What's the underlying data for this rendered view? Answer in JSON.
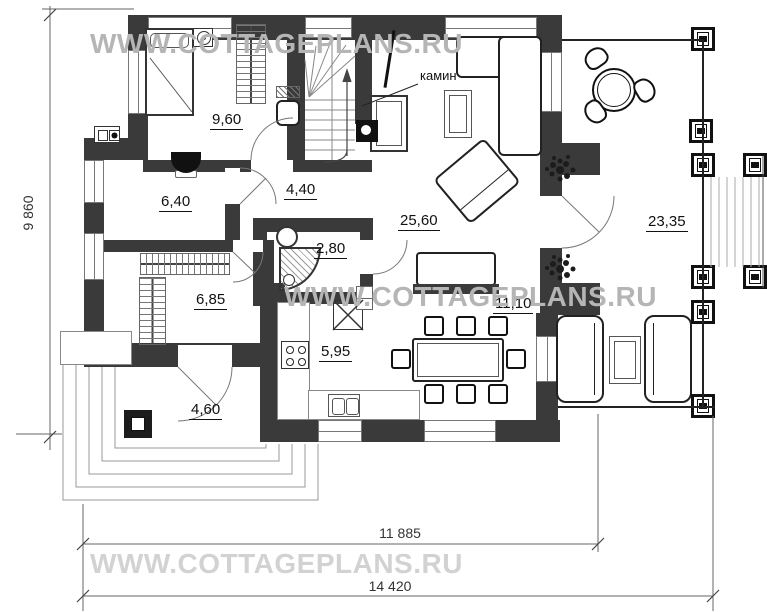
{
  "watermarks": {
    "top": "WWW.COTTAGEPLANS.RU",
    "middle": "WWW.COTTAGEPLANS.RU",
    "bottom": "WWW.COTTAGEPLANS.RU"
  },
  "dimensions": {
    "height_total": "9 860",
    "width_main": "11 885",
    "width_total": "14 420"
  },
  "annotations": {
    "fireplace": "камин"
  },
  "rooms": [
    {
      "name": "bedroom",
      "area": "9,60"
    },
    {
      "name": "room-left",
      "area": "6,40"
    },
    {
      "name": "hallway",
      "area": "4,40"
    },
    {
      "name": "shower-room",
      "area": "2,80"
    },
    {
      "name": "entry-hall",
      "area": "6,85"
    },
    {
      "name": "living-room",
      "area": "25,60"
    },
    {
      "name": "dining-area",
      "area": "11,10"
    },
    {
      "name": "kitchen",
      "area": "5,95"
    },
    {
      "name": "porch",
      "area": "4,60"
    },
    {
      "name": "terrace",
      "area": "23,35"
    }
  ],
  "colors": {
    "wall": "#3a3a3a",
    "watermark": "#b5b5b5",
    "watermark_light": "#d2d2d2",
    "line": "#666666"
  }
}
